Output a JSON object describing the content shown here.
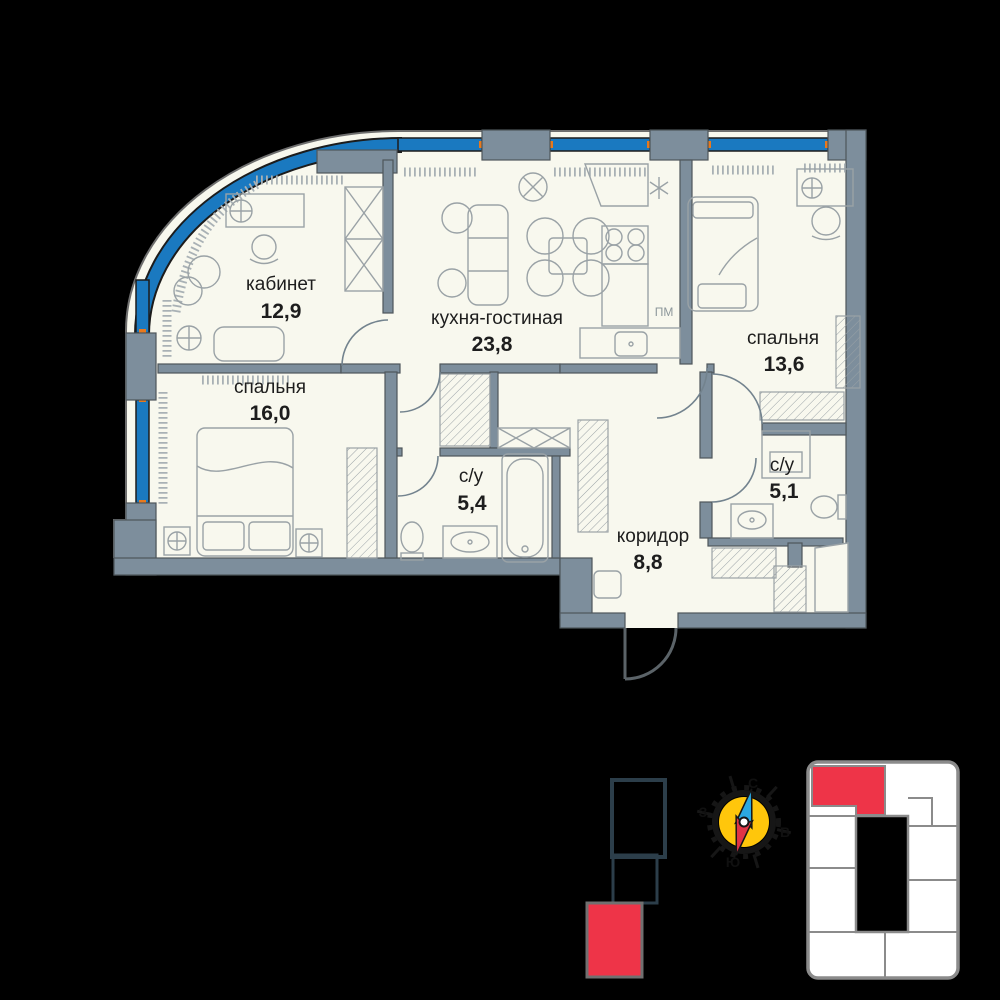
{
  "plan": {
    "rooms": [
      {
        "key": "office",
        "label": "кабинет",
        "area": "12,9"
      },
      {
        "key": "kitchen_living",
        "label": "кухня-гостиная",
        "area": "23,8"
      },
      {
        "key": "bedroom_right",
        "label": "спальня",
        "area": "13,6"
      },
      {
        "key": "bedroom_left",
        "label": "спальня",
        "area": "16,0"
      },
      {
        "key": "bath_main",
        "label": "с/у",
        "area": "5,4"
      },
      {
        "key": "bath_guest",
        "label": "с/у",
        "area": "5,1"
      },
      {
        "key": "hall",
        "label": "коридор",
        "area": "8,8"
      }
    ],
    "appliances": {
      "dishwasher": "ПМ"
    }
  },
  "compass": {
    "north": "С",
    "east": "В",
    "south": "Ю",
    "west": "З"
  },
  "colors": {
    "background": "#000000",
    "floor": "#f8f8ee",
    "walls": "#7d8e9c",
    "window_glass": "#1a79c0",
    "accent_orange": "#e8791d",
    "highlight_red": "#ee3448",
    "compass_yellow": "#ffc60b",
    "indicator_outline": "#2c3e4a",
    "keyplan_outline": "#8b8b8b"
  }
}
